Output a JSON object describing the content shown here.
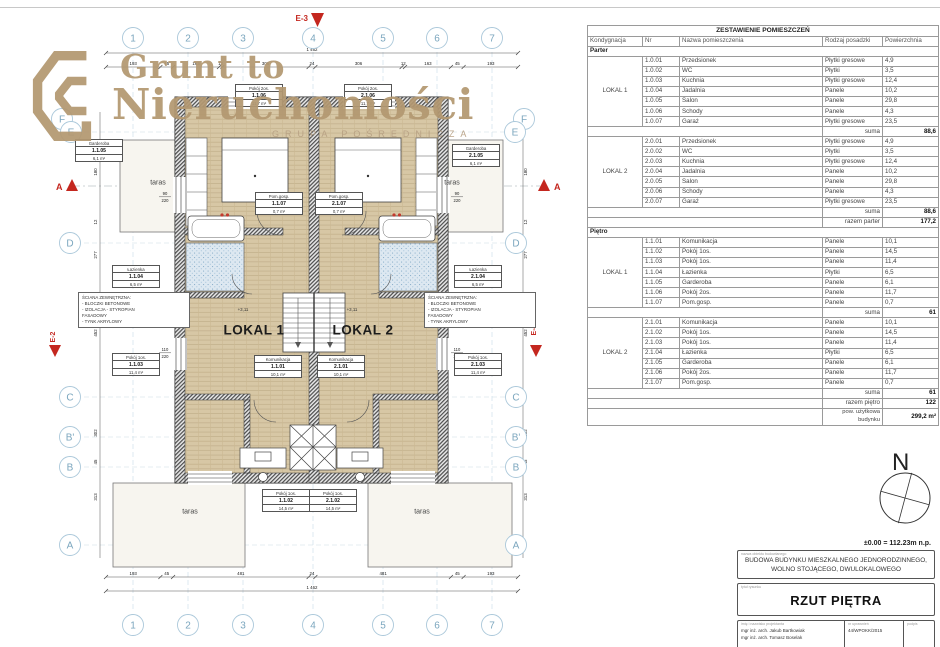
{
  "logo": {
    "line1": "Grunt to",
    "line2": "Nieruchomości",
    "subtitle": "GRUPA POŚREDNICZA",
    "color": "#b39871"
  },
  "plan": {
    "grid": {
      "top": [
        "1",
        "2",
        "3",
        "4",
        "5",
        "6",
        "7"
      ],
      "bottom": [
        "1",
        "2",
        "3",
        "4",
        "5",
        "6",
        "7"
      ],
      "left": [
        "F",
        "E",
        "D",
        "C",
        "B'",
        "B",
        "A"
      ],
      "right": [
        "F",
        "E",
        "D",
        "C",
        "B'",
        "B",
        "A"
      ]
    },
    "markers": {
      "e3": "E-3",
      "e2": "E-2",
      "e4": "E-4",
      "section_a": "A"
    },
    "units": [
      "LOKAL 1",
      "LOKAL 2"
    ],
    "taras": "taras",
    "elevation": "+3,11",
    "wall_note": "ŚCIANA ZEWNĘTRZNA:\n- BLOCZKI BETONOWE\n- IZOLACJA - STYROPIAN\n  FASADOWY\n- TYNK AKRYLOWY",
    "rooms": [
      {
        "name": "Pokój 2os.",
        "nr": "1.1.06",
        "area": "11,7 m²"
      },
      {
        "name": "Pokój 2os.",
        "nr": "2.1.06",
        "area": "11,7 m²"
      },
      {
        "name": "Garderoba",
        "nr": "1.1.05",
        "area": "6,1 m²"
      },
      {
        "name": "Garderoba",
        "nr": "2.1.05",
        "area": "6,1 m²"
      },
      {
        "name": "Pom.gosp.",
        "nr": "1.1.07",
        "area": "0,7 m²"
      },
      {
        "name": "Pom.gosp.",
        "nr": "2.1.07",
        "area": "0,7 m²"
      },
      {
        "name": "Łazienka",
        "nr": "1.1.04",
        "area": "6,5 m²"
      },
      {
        "name": "Łazienka",
        "nr": "2.1.04",
        "area": "6,5 m²"
      },
      {
        "name": "Pokój 1os.",
        "nr": "1.1.03",
        "area": "11,4 m²"
      },
      {
        "name": "Pokój 1os.",
        "nr": "2.1.03",
        "area": "11,4 m²"
      },
      {
        "name": "Komunikacja",
        "nr": "1.1.01",
        "area": "10,1 m²"
      },
      {
        "name": "Komunikacja",
        "nr": "2.1.01",
        "area": "10,1 m²"
      },
      {
        "name": "Pokój 1os.",
        "nr": "1.1.02",
        "area": "14,5 m²"
      },
      {
        "name": "Pokój 1os.",
        "nr": "2.1.02",
        "area": "14,5 m²"
      }
    ],
    "dims": {
      "top": [
        "193",
        "45",
        "163",
        "12",
        "306",
        "24",
        "306",
        "12",
        "163",
        "45",
        "193"
      ],
      "top_total": "1 462",
      "bottom": [
        "193",
        "45",
        "481",
        "24",
        "481",
        "45",
        "193"
      ],
      "bottom_total": "1 462",
      "left": [
        "180",
        "12",
        "277",
        "452",
        "302",
        "45",
        "313"
      ],
      "right": [
        "180",
        "12",
        "277",
        "452",
        "302",
        "45",
        "313"
      ],
      "windows": [
        "90|220",
        "60|220",
        "110|220"
      ]
    }
  },
  "schedule": {
    "title": "ZESTAWIENIE POMIESZCZEŃ",
    "columns": [
      "Kondygnacja",
      "Nr",
      "Nazwa pomieszczenia",
      "Rodzaj posadzki",
      "Powierzchnia"
    ],
    "suma_label": "suma",
    "sections": [
      {
        "name": "Parter",
        "total_label": "razem parter",
        "total": "177,2",
        "groups": [
          {
            "unit": "LOKAL 1",
            "suma": "88,6",
            "rows": [
              [
                "1.0.01",
                "Przedsionek",
                "Płytki gresowe",
                "4,9"
              ],
              [
                "1.0.02",
                "WC",
                "Płytki",
                "3,5"
              ],
              [
                "1.0.03",
                "Kuchnia",
                "Płytki gresowe",
                "12,4"
              ],
              [
                "1.0.04",
                "Jadalnia",
                "Panele",
                "10,2"
              ],
              [
                "1.0.05",
                "Salon",
                "Panele",
                "29,8"
              ],
              [
                "1.0.06",
                "Schody",
                "Panele",
                "4,3"
              ],
              [
                "1.0.07",
                "Garaż",
                "Płytki gresowe",
                "23,5"
              ]
            ]
          },
          {
            "unit": "LOKAL 2",
            "suma": "88,6",
            "rows": [
              [
                "2.0.01",
                "Przedsionek",
                "Płytki gresowe",
                "4,9"
              ],
              [
                "2.0.02",
                "WC",
                "Płytki",
                "3,5"
              ],
              [
                "2.0.03",
                "Kuchnia",
                "Płytki gresowe",
                "12,4"
              ],
              [
                "2.0.04",
                "Jadalnia",
                "Panele",
                "10,2"
              ],
              [
                "2.0.05",
                "Salon",
                "Panele",
                "29,8"
              ],
              [
                "2.0.06",
                "Schody",
                "Panele",
                "4,3"
              ],
              [
                "2.0.07",
                "Garaż",
                "Płytki gresowe",
                "23,5"
              ]
            ]
          }
        ]
      },
      {
        "name": "Piętro",
        "total_label": "razem piętro",
        "total": "122",
        "groups": [
          {
            "unit": "LOKAL 1",
            "suma": "61",
            "rows": [
              [
                "1.1.01",
                "Komunikacja",
                "Panele",
                "10,1"
              ],
              [
                "1.1.02",
                "Pokój 1os.",
                "Panele",
                "14,5"
              ],
              [
                "1.1.03",
                "Pokój 1os.",
                "Panele",
                "11,4"
              ],
              [
                "1.1.04",
                "Łazienka",
                "Płytki",
                "6,5"
              ],
              [
                "1.1.05",
                "Garderoba",
                "Panele",
                "6,1"
              ],
              [
                "1.1.06",
                "Pokój 2os.",
                "Panele",
                "11,7"
              ],
              [
                "1.1.07",
                "Pom.gosp.",
                "Panele",
                "0,7"
              ]
            ]
          },
          {
            "unit": "LOKAL 2",
            "suma": "61",
            "rows": [
              [
                "2.1.01",
                "Komunikacja",
                "Panele",
                "10,1"
              ],
              [
                "2.1.02",
                "Pokój 1os.",
                "Panele",
                "14,5"
              ],
              [
                "2.1.03",
                "Pokój 1os.",
                "Panele",
                "11,4"
              ],
              [
                "2.1.04",
                "Łazienka",
                "Płytki",
                "6,5"
              ],
              [
                "2.1.05",
                "Garderoba",
                "Panele",
                "6,1"
              ],
              [
                "2.1.06",
                "Pokój 2os.",
                "Panele",
                "11,7"
              ],
              [
                "2.1.07",
                "Pom.gosp.",
                "Panele",
                "0,7"
              ]
            ]
          }
        ]
      }
    ],
    "footer": {
      "label": "pow. użytkowa\nbudynku",
      "value": "299,2 m²"
    }
  },
  "titleblock": {
    "north": "N",
    "elevation_ref": "±0.00 = 112.23m n.p.",
    "project_label": "nazwa obiektu budowlanego",
    "project_name": "Budowa budynku mieszkalnego jednorodzinnego, wolno stojącego, dwulokalowego",
    "drawing_label": "tytuł rysunku",
    "drawing_title": "RZUT PIĘTRA",
    "designers_label": "imię i nazwisko projektanta",
    "designers": [
      "mgr inż. arch. Jakub Bartkowiak",
      "mgr inż. arch. Tomasz Boselak"
    ],
    "permit_label": "nr uprawnień",
    "permit": "44/WPOKK/2015",
    "signature_label": "podpis"
  }
}
